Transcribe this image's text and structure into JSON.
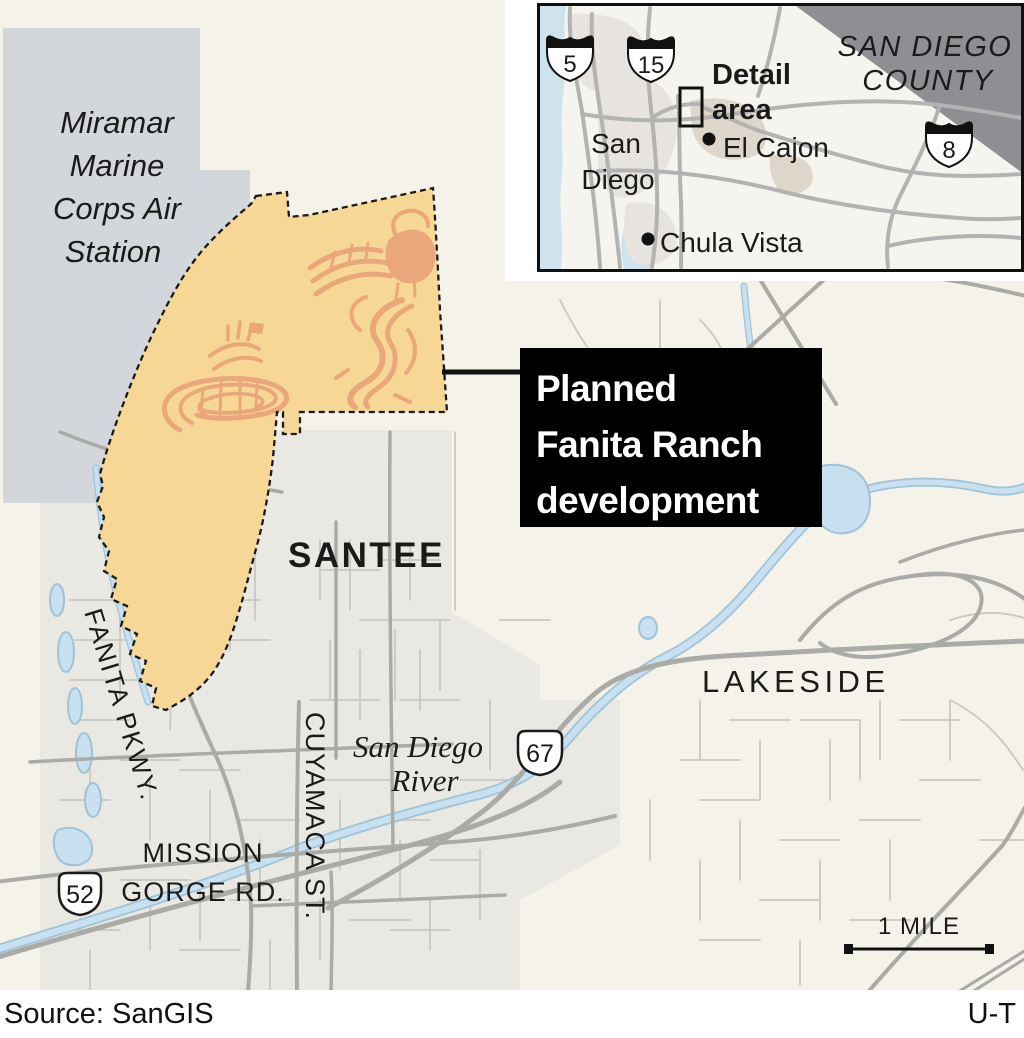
{
  "colors": {
    "map_background": "#f5f2ea",
    "urban_area": "#e9e8e2",
    "military_area": "#d3d6da",
    "development_area": "#f6d795",
    "development_streets": "#eaa77c",
    "road_major": "#aaaaa7",
    "road_minor": "#c9c8c3",
    "water_fill": "#c8e0ef",
    "water_edge": "#9fc3d8",
    "callout_background": "#000000",
    "callout_text": "#ffffff",
    "label_text": "#1a1a1a",
    "inset_ocean": "#cfe3ee",
    "inset_outside_county": "#8d8f92",
    "inset_urban": "#e7e4df",
    "inset_urban_tan": "#ded6cb",
    "panel_background": "#ffffff"
  },
  "main_map": {
    "miramar_label": {
      "line1": "Miramar",
      "line2": "Marine",
      "line3": "Corps Air",
      "line4": "Station"
    },
    "city_labels": {
      "santee": "SANTEE",
      "lakeside": "LAKESIDE"
    },
    "street_labels": {
      "fanita_pkwy": "FANITA PKWY.",
      "cuyamaca": "CUYAMACA ST.",
      "mission_gorge_line1": "MISSION",
      "mission_gorge_line2": "GORGE RD."
    },
    "river_label": {
      "line1": "San Diego",
      "line2": "River"
    },
    "shields": {
      "route52": "52",
      "route67": "67"
    },
    "scale_bar_label": "1 MILE"
  },
  "callout": {
    "line1": "Planned",
    "line2": "Fanita Ranch",
    "line3": "development"
  },
  "inset": {
    "county_label": {
      "line1": "SAN DIEGO",
      "line2": "COUNTY"
    },
    "detail_label": {
      "line1": "Detail",
      "line2": "area"
    },
    "city_labels": {
      "san_diego_line1": "San",
      "san_diego_line2": "Diego",
      "el_cajon": "El Cajon",
      "chula_vista": "Chula Vista"
    },
    "shields": {
      "i5": "5",
      "i15": "15",
      "i8": "8"
    }
  },
  "footer": {
    "source": "Source: SanGIS",
    "credit": "U-T"
  }
}
